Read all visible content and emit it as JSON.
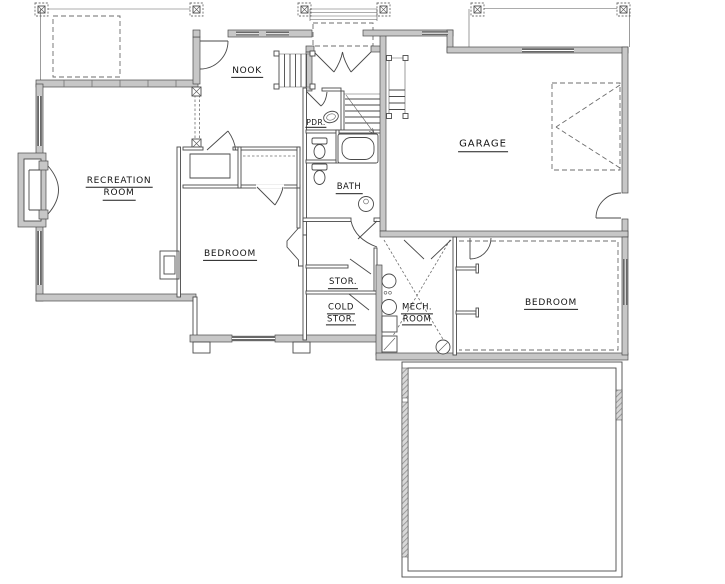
{
  "plan": {
    "drawing_type": "basement floor plan",
    "colors": {
      "background": "#ffffff",
      "wall_fill": "#c7c7c7",
      "line": "#4a4a4a",
      "window_fill": "#686868",
      "dashed_line": "#6d6d6d",
      "text": "#141414"
    },
    "rooms": [
      {
        "id": "recreation-room",
        "label_lines": [
          "RECREATION",
          "ROOM"
        ]
      },
      {
        "id": "nook",
        "label_lines": [
          "NOOK"
        ]
      },
      {
        "id": "pdr",
        "label_lines": [
          "PDR."
        ]
      },
      {
        "id": "bath",
        "label_lines": [
          "BATH"
        ]
      },
      {
        "id": "garage",
        "label_lines": [
          "GARAGE"
        ]
      },
      {
        "id": "bedroom-left",
        "label_lines": [
          "BEDROOM"
        ]
      },
      {
        "id": "storage",
        "label_lines": [
          "STOR."
        ]
      },
      {
        "id": "cold-storage",
        "label_lines": [
          "COLD",
          "STOR."
        ]
      },
      {
        "id": "mech-room",
        "label_lines": [
          "MECH.",
          "ROOM"
        ]
      },
      {
        "id": "bedroom-right",
        "label_lines": [
          "BEDROOM"
        ]
      }
    ]
  }
}
